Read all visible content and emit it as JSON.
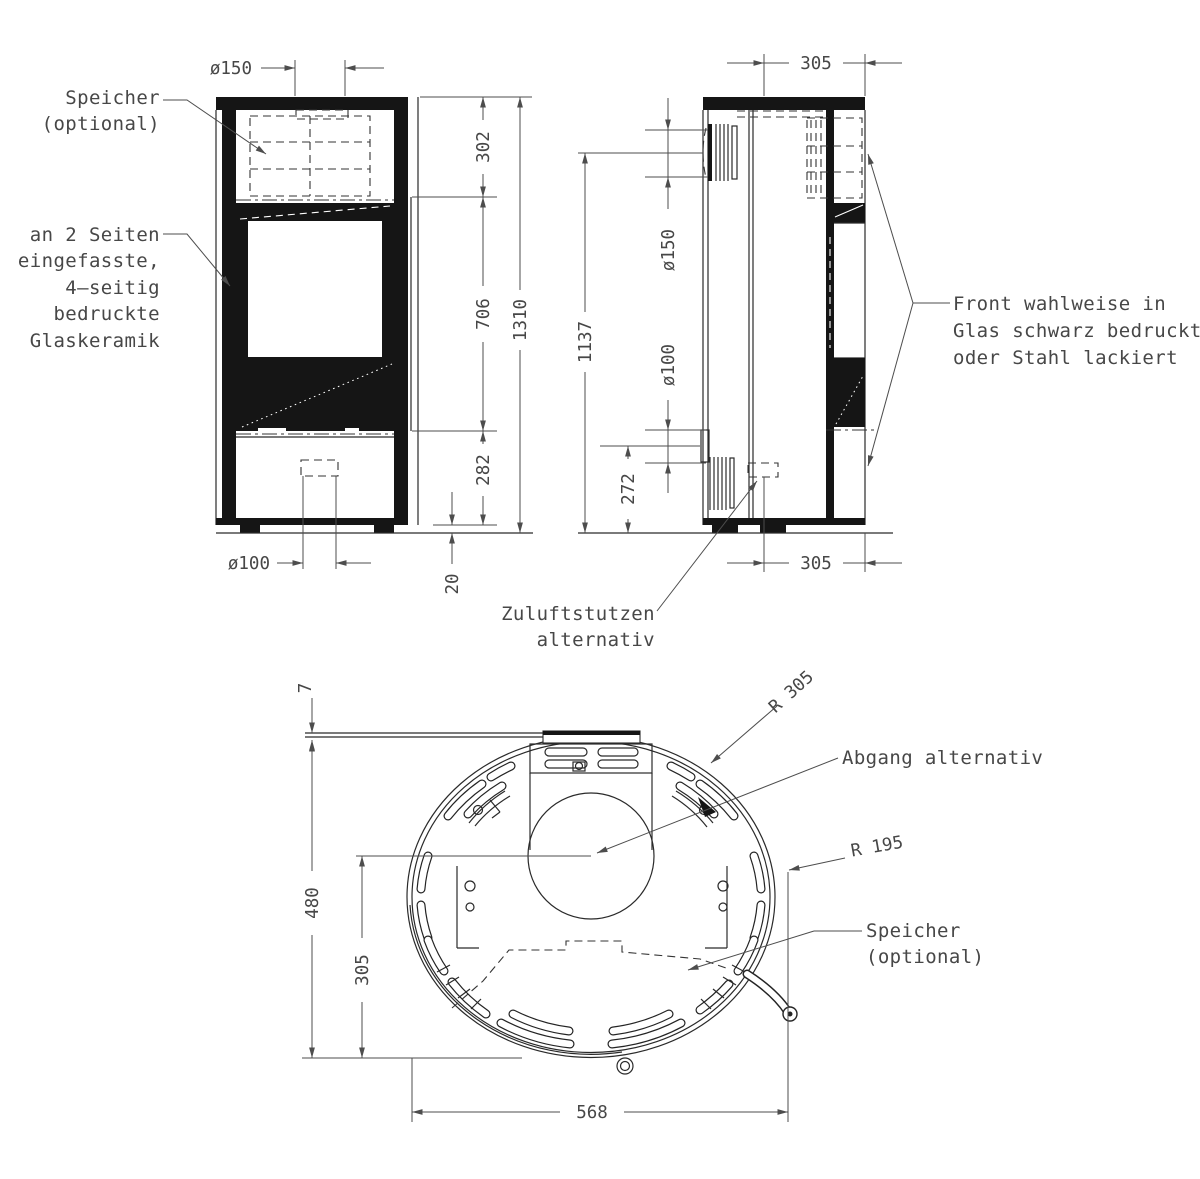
{
  "front_view": {
    "dims": {
      "flue": "ø150",
      "upper": "302",
      "middle": "706",
      "overall": "1310",
      "lower": "282",
      "feet": "20",
      "inlet": "ø100"
    },
    "labels": {
      "speicher1": "Speicher",
      "speicher2": "(optional)",
      "glass1": "an 2 Seiten",
      "glass2": "eingefasste,",
      "glass3": "4–seitig",
      "glass4": "bedruckte",
      "glass5": "Glaskeramik"
    }
  },
  "side_view": {
    "dims": {
      "depth_top": "305",
      "flue": "ø150",
      "inlet": "ø100",
      "flue_height": "1137",
      "inlet_height": "272",
      "depth_bottom": "305"
    },
    "labels": {
      "front1": "Front wahlweise in",
      "front2": "Glas schwarz bedruckt",
      "front3": "oder Stahl lackiert",
      "zuluft1": "Zuluftstutzen",
      "zuluft2": "alternativ"
    }
  },
  "plan_view": {
    "dims": {
      "wall_gap": "7",
      "depth": "480",
      "flue_to_front": "305",
      "width": "568",
      "rear_radius": "R 305",
      "front_radius": "R 195"
    },
    "labels": {
      "abgang": "Abgang alternativ",
      "speicher1": "Speicher",
      "speicher2": "(optional)"
    }
  }
}
